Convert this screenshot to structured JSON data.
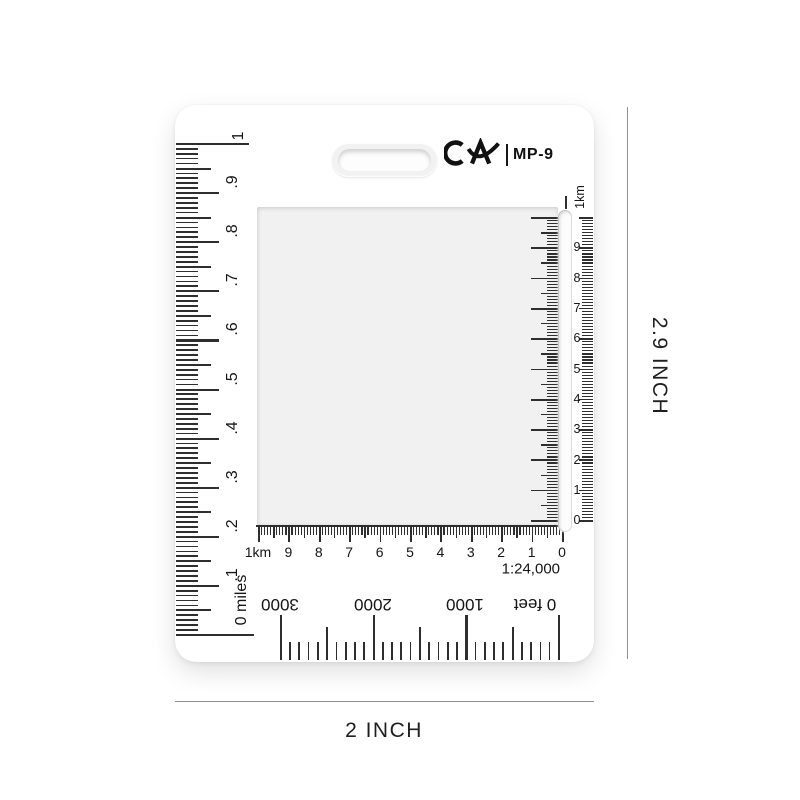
{
  "product": {
    "brand": "CA",
    "model": "MP-9",
    "scale_ratio": "1:24,000"
  },
  "dimensions": {
    "height_label": "2.9 INCH",
    "width_label": "2 INCH"
  },
  "rulers": {
    "miles": {
      "max_label": "1",
      "labels": [
        ".9",
        ".8",
        ".7",
        ".6",
        ".5",
        ".4",
        ".3",
        ".2",
        ".1"
      ],
      "zero_label": "0 miles",
      "subdivisions_per_major": 10,
      "majors": 10
    },
    "km_horizontal": {
      "labels": [
        "1km",
        "9",
        "8",
        "7",
        "6",
        "5",
        "4",
        "3",
        "2",
        "1",
        "0"
      ],
      "subdivisions_per_major": 10
    },
    "km_vertical": {
      "top_label": "1km",
      "labels": [
        "9",
        "8",
        "7",
        "6",
        "5",
        "4",
        "3",
        "2",
        "1",
        "0"
      ],
      "subdivisions_per_major": 10
    },
    "feet": {
      "labels": [
        "3000",
        "2000",
        "1000"
      ],
      "zero_label": "0 feet",
      "step_feet": 100,
      "max_feet": 3000
    }
  }
}
